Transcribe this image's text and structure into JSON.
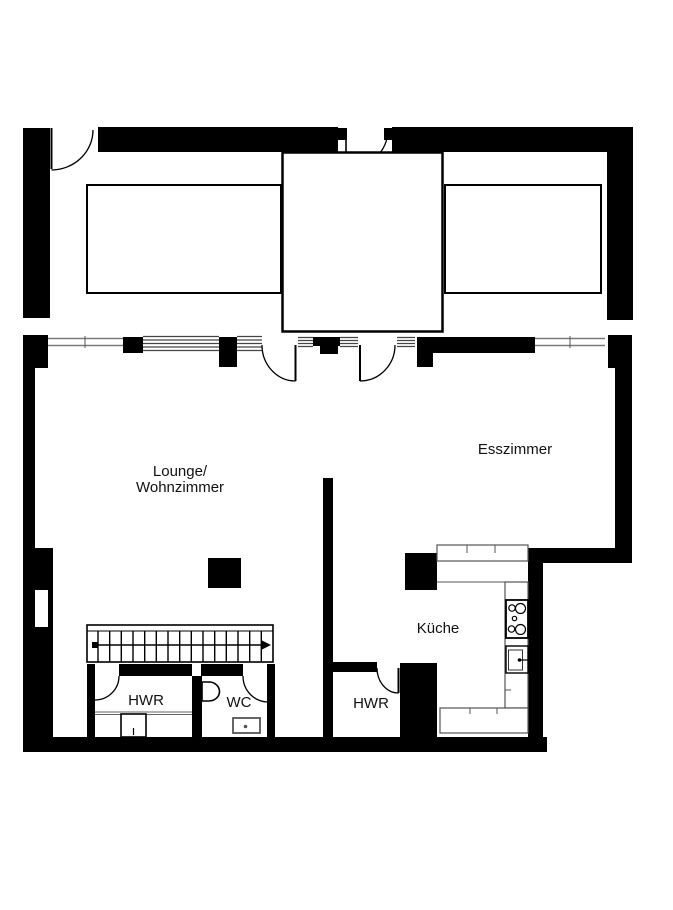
{
  "floorplan": {
    "colors": {
      "wall": "#000000",
      "background": "#ffffff",
      "window_line": "#7a7a7a"
    },
    "rooms": {
      "lounge": {
        "label_line1": "Lounge/",
        "label_line2": "Wohnzimmer"
      },
      "dining": {
        "label": "Esszimmer"
      },
      "kitchen": {
        "label": "Küche"
      },
      "utility_left": {
        "label": "HWR"
      },
      "wc": {
        "label": "WC"
      },
      "utility_right": {
        "label": "HWR"
      }
    },
    "fixtures": {
      "stairs": "straight-stair-run-with-direction-arrow",
      "kitchen_counter": "u-shaped-counter",
      "stove": "four-burner-cooktop",
      "kitchen_sink": "sink-with-tap",
      "wc_basin": "washbasin",
      "wc_cistern": "small-cistern",
      "utility_appliance": "washing-machine"
    }
  }
}
